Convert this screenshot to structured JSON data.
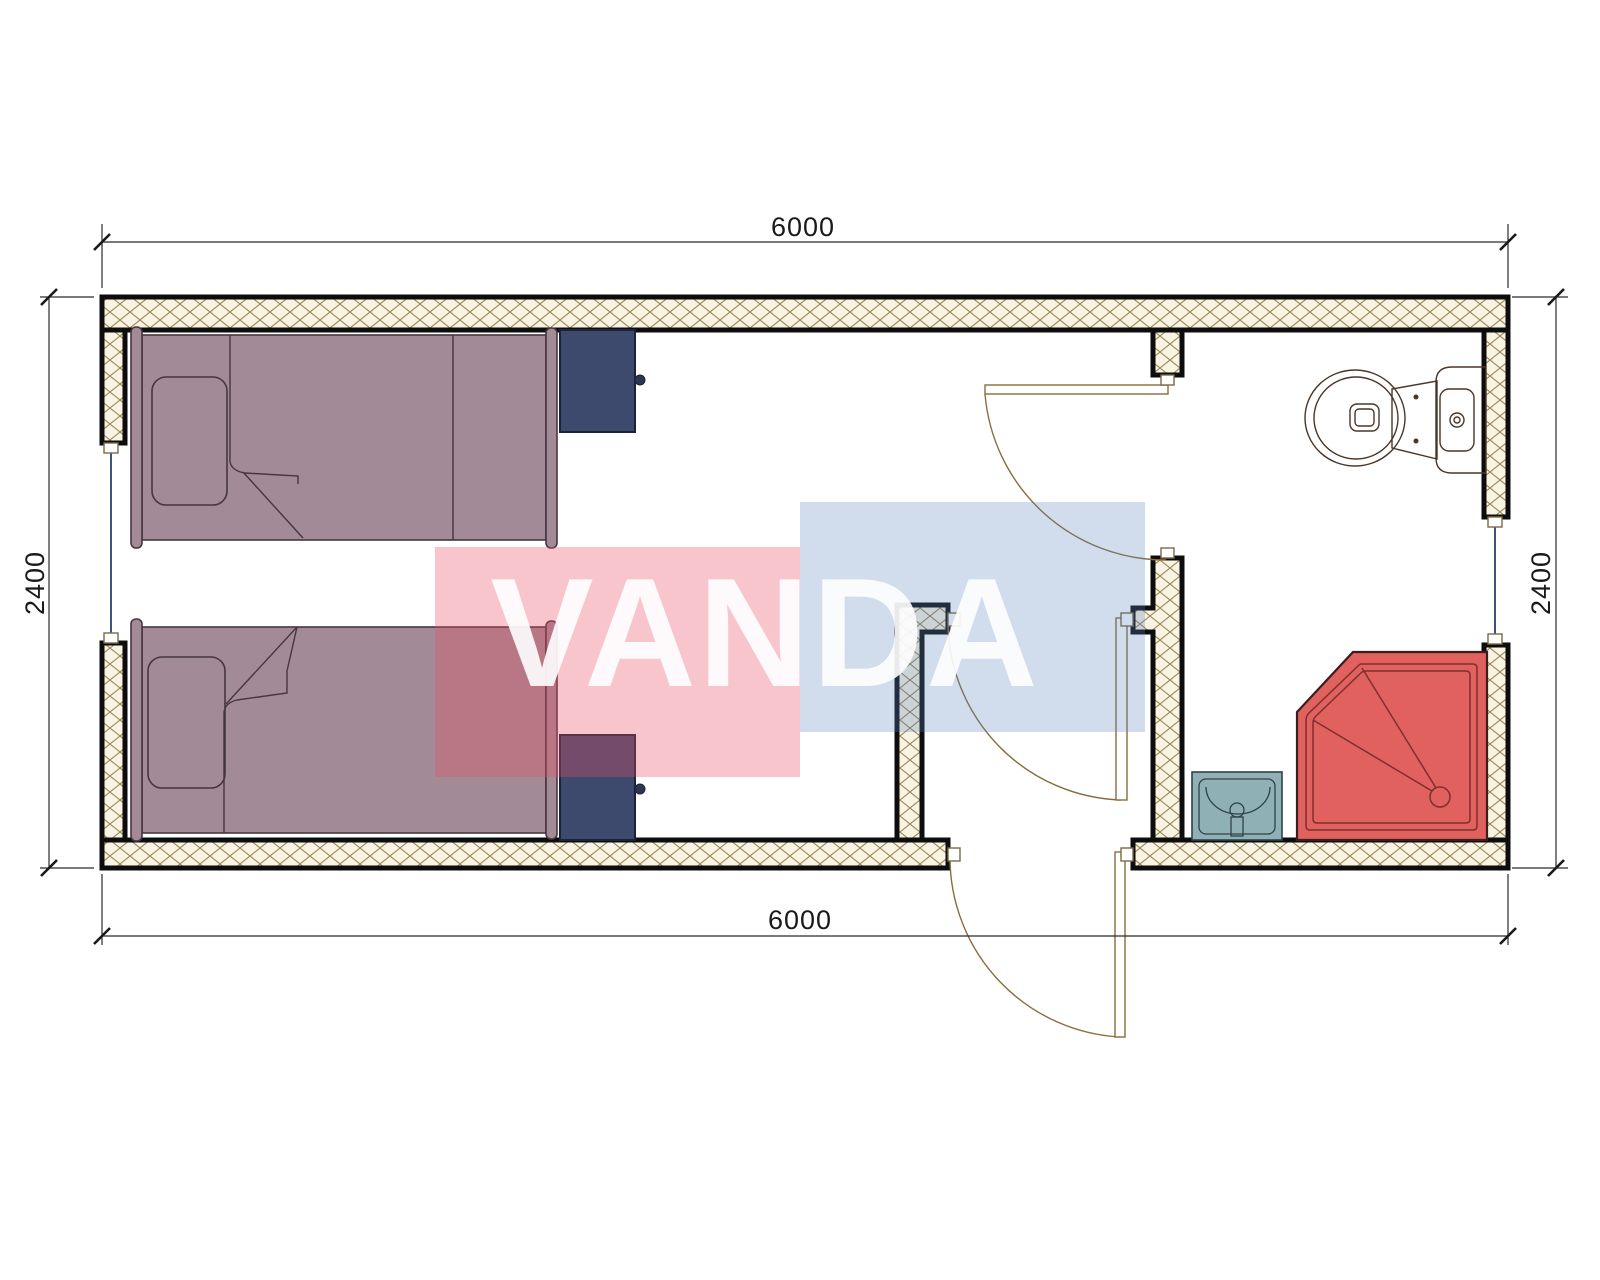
{
  "watermark": {
    "text": "VANDA",
    "pink": "#e94e68",
    "blue": "#5a82b9",
    "text_color": "#ffffff"
  },
  "dimensions": {
    "top": "6000",
    "bottom": "6000",
    "left": "2400",
    "right": "2400"
  },
  "colors": {
    "wall_hatch_bg": "#f8f3e2",
    "wall_hatch_line": "#9b8a5c",
    "wall_outline": "#0d0d0d",
    "bed": "#a28b96",
    "pillow": "#a28b96",
    "nightstand": "#3d4a6d",
    "nightstand_knob": "#2c3552",
    "toilet": "#d6b494",
    "sink": "#8fb0b5",
    "shower": "#e0615e",
    "door_line": "#8a6d3b",
    "window_line": "#27406e",
    "dimension_line": "#2b2b2b"
  }
}
